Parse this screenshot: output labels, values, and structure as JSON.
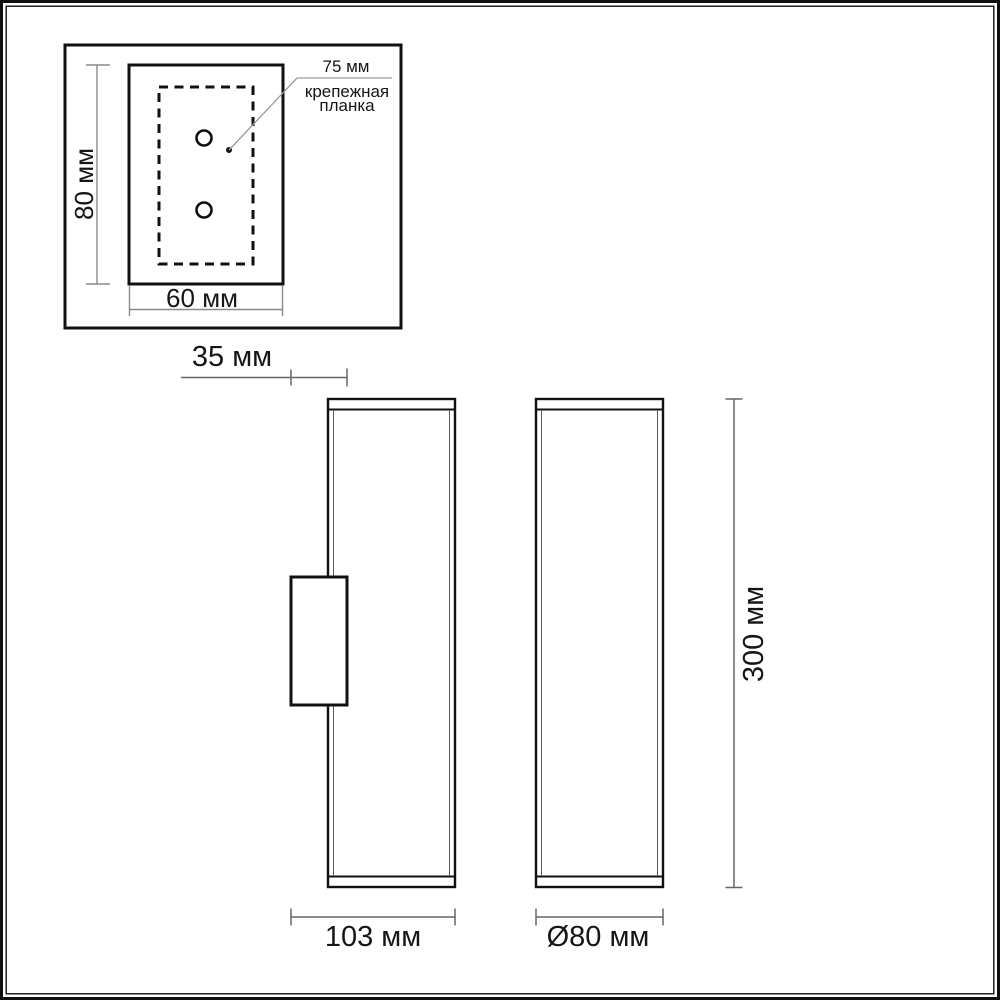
{
  "drawing": {
    "kind": "wall-lamp dimensional drawing",
    "detail_view": {
      "height_label": "80 мм",
      "width_label": "60 мм",
      "bracket_length_label": "75 мм",
      "bracket_note": "крепежная\nпланка",
      "hole_count": 2
    },
    "side_view": {
      "bracket_depth_label": "35 мм",
      "total_depth_label": "103 мм"
    },
    "front_view": {
      "diameter_label": "Ø80 мм",
      "height_label": "300 мм"
    },
    "colors": {
      "background": "#ffffff",
      "outline": "#111111",
      "dimension_line": "#666666",
      "detail_dimension_line": "#8a8a8a",
      "leader_line": "#9a9a9a",
      "text": "#161616"
    }
  }
}
